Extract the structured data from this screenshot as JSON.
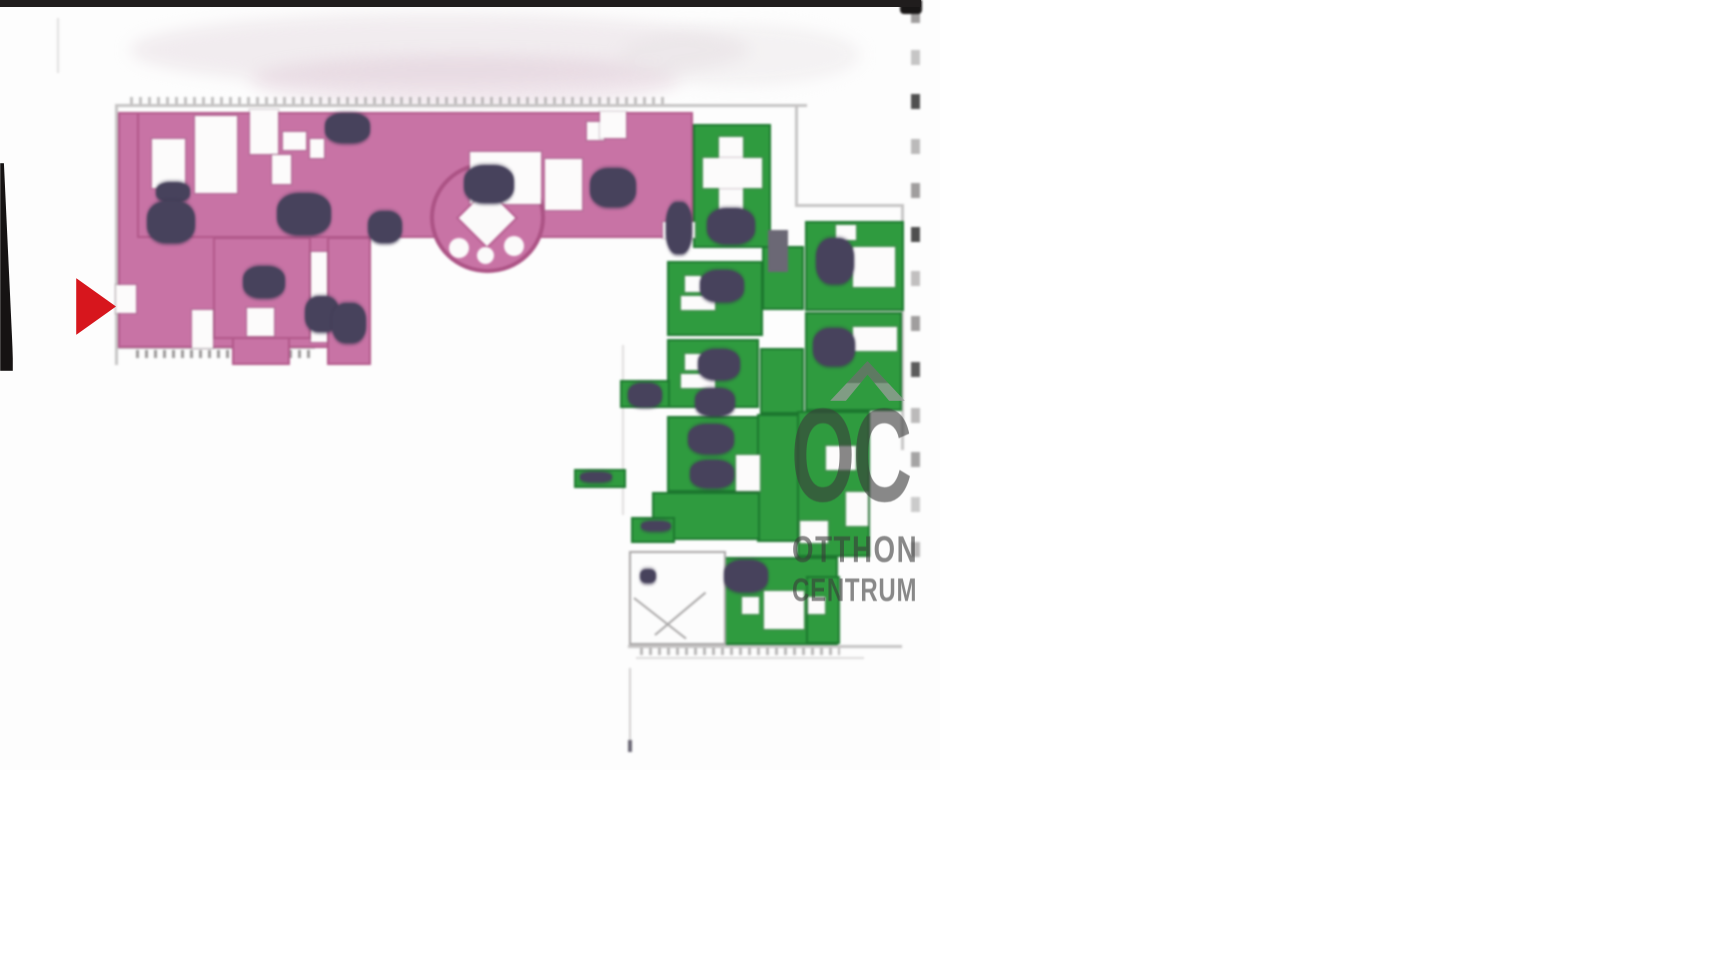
{
  "watermark": {
    "logo": "OC",
    "line1": "OTTHON",
    "line2": "CENTRUM",
    "color": "#6e6e6e"
  },
  "marker": {
    "color": "#d7161d"
  },
  "colors": {
    "highlight_pink": "#c873a5",
    "highlight_green": "#2f9b3f",
    "furniture_dark": "#47425c",
    "wall_gray": "#c6c4c4",
    "scan_bar_black": "#201d1d"
  },
  "floorplan": {
    "shapes": [
      {
        "c": "smudge",
        "x": 130,
        "y": 14,
        "w": 620,
        "h": 72,
        "bg": "rgba(226,216,222,0.45)"
      },
      {
        "c": "smudge",
        "x": 250,
        "y": 55,
        "w": 430,
        "h": 50,
        "bg": "rgba(219,196,209,0.4)"
      },
      {
        "c": "smudge",
        "x": 620,
        "y": 25,
        "w": 240,
        "h": 60,
        "bg": "rgba(230,224,228,0.4)"
      },
      {
        "c": "wall",
        "x": 115,
        "y": 104,
        "w": 692,
        "h": 3
      },
      {
        "c": "wall",
        "x": 115,
        "y": 107,
        "w": 3,
        "h": 258
      },
      {
        "c": "wall",
        "x": 795,
        "y": 107,
        "w": 3,
        "h": 100
      },
      {
        "c": "wall",
        "x": 795,
        "y": 204,
        "w": 109,
        "h": 3
      },
      {
        "c": "wall",
        "x": 901,
        "y": 204,
        "w": 3,
        "h": 246
      },
      {
        "c": "wall",
        "x": 115,
        "y": 346,
        "w": 200,
        "h": 3
      },
      {
        "c": "wall",
        "x": 628,
        "y": 645,
        "w": 274,
        "h": 3
      },
      {
        "c": "wall",
        "x": 636,
        "y": 657,
        "w": 228,
        "h": 2,
        "o": 0.6
      },
      {
        "c": "wall",
        "x": 622,
        "y": 345,
        "w": 2,
        "h": 170,
        "o": 0.55
      },
      {
        "c": "wall",
        "x": 57,
        "y": 18,
        "w": 2,
        "h": 55,
        "o": 0.5
      },
      {
        "c": "wall",
        "x": 629,
        "y": 668,
        "w": 2,
        "h": 78,
        "o": 0.8
      },
      {
        "c": "wall-dark",
        "x": 628,
        "y": 740,
        "w": 4,
        "h": 12
      },
      {
        "c": "ticks",
        "x": 136,
        "y": 350,
        "w": 175,
        "h": 8
      },
      {
        "c": "ticks",
        "x": 640,
        "y": 648,
        "w": 200,
        "h": 7,
        "o": 0.7
      },
      {
        "c": "ticks",
        "x": 130,
        "y": 97,
        "w": 540,
        "h": 7,
        "o": 0.6
      },
      {
        "c": "pink",
        "x": 118,
        "y": 112,
        "w": 227,
        "h": 236
      },
      {
        "c": "pink",
        "x": 137,
        "y": 112,
        "w": 556,
        "h": 126
      },
      {
        "c": "pink",
        "x": 213,
        "y": 237,
        "w": 98,
        "h": 102
      },
      {
        "c": "pink",
        "x": 232,
        "y": 337,
        "w": 58,
        "h": 28
      },
      {
        "c": "pink",
        "x": 327,
        "y": 237,
        "w": 44,
        "h": 128
      },
      {
        "c": "oval",
        "x": 430,
        "y": 162,
        "w": 115,
        "h": 111
      },
      {
        "c": "green",
        "x": 693,
        "y": 124,
        "w": 78,
        "h": 124
      },
      {
        "c": "green",
        "x": 805,
        "y": 221,
        "w": 99,
        "h": 90
      },
      {
        "c": "green",
        "x": 805,
        "y": 312,
        "w": 97,
        "h": 99
      },
      {
        "c": "green",
        "x": 667,
        "y": 261,
        "w": 96,
        "h": 75
      },
      {
        "c": "green",
        "x": 667,
        "y": 339,
        "w": 92,
        "h": 69
      },
      {
        "c": "green",
        "x": 620,
        "y": 380,
        "w": 50,
        "h": 28
      },
      {
        "c": "green",
        "x": 667,
        "y": 416,
        "w": 92,
        "h": 76
      },
      {
        "c": "green",
        "x": 762,
        "y": 246,
        "w": 42,
        "h": 64
      },
      {
        "c": "green",
        "x": 760,
        "y": 348,
        "w": 44,
        "h": 66
      },
      {
        "c": "green",
        "x": 757,
        "y": 414,
        "w": 45,
        "h": 128
      },
      {
        "c": "green",
        "x": 652,
        "y": 492,
        "w": 108,
        "h": 48
      },
      {
        "c": "green",
        "x": 631,
        "y": 517,
        "w": 44,
        "h": 26
      },
      {
        "c": "green",
        "x": 574,
        "y": 469,
        "w": 52,
        "h": 19
      },
      {
        "c": "green",
        "x": 722,
        "y": 557,
        "w": 116,
        "h": 88
      },
      {
        "c": "green",
        "x": 797,
        "y": 411,
        "w": 73,
        "h": 146
      },
      {
        "c": "green",
        "x": 806,
        "y": 576,
        "w": 34,
        "h": 68
      },
      {
        "c": "cutout",
        "x": 152,
        "y": 139,
        "w": 33,
        "h": 49
      },
      {
        "c": "cutout",
        "x": 195,
        "y": 116,
        "w": 42,
        "h": 77
      },
      {
        "c": "cutout",
        "x": 250,
        "y": 110,
        "w": 28,
        "h": 44
      },
      {
        "c": "cutout",
        "x": 272,
        "y": 155,
        "w": 19,
        "h": 29
      },
      {
        "c": "cutout",
        "x": 283,
        "y": 132,
        "w": 23,
        "h": 18
      },
      {
        "c": "cutout",
        "x": 310,
        "y": 139,
        "w": 14,
        "h": 19
      },
      {
        "c": "cutout",
        "x": 470,
        "y": 152,
        "w": 71,
        "h": 52
      },
      {
        "c": "cutout",
        "x": 545,
        "y": 159,
        "w": 37,
        "h": 51
      },
      {
        "c": "cutout",
        "x": 587,
        "y": 122,
        "w": 17,
        "h": 18
      },
      {
        "c": "cutout",
        "x": 600,
        "y": 112,
        "w": 26,
        "h": 26
      },
      {
        "c": "cutout",
        "x": 663,
        "y": 222,
        "w": 32,
        "h": 16
      },
      {
        "c": "cutout",
        "x": 192,
        "y": 310,
        "w": 21,
        "h": 38
      },
      {
        "c": "cutout",
        "x": 247,
        "y": 308,
        "w": 27,
        "h": 28
      },
      {
        "c": "cutout",
        "x": 311,
        "y": 252,
        "w": 16,
        "h": 90
      },
      {
        "c": "cutout",
        "x": 116,
        "y": 285,
        "w": 20,
        "h": 28
      },
      {
        "c": "diamond",
        "x": 467,
        "y": 198,
        "w": 40,
        "h": 40
      },
      {
        "c": "circle",
        "x": 449,
        "y": 238,
        "w": 20,
        "h": 20
      },
      {
        "c": "circle",
        "x": 477,
        "y": 247,
        "w": 17,
        "h": 17
      },
      {
        "c": "circle",
        "x": 504,
        "y": 236,
        "w": 20,
        "h": 20
      },
      {
        "c": "cutout",
        "x": 719,
        "y": 137,
        "w": 24,
        "h": 74
      },
      {
        "c": "cutout",
        "x": 703,
        "y": 158,
        "w": 59,
        "h": 30
      },
      {
        "c": "cutout",
        "x": 853,
        "y": 247,
        "w": 42,
        "h": 40
      },
      {
        "c": "cutout",
        "x": 836,
        "y": 225,
        "w": 20,
        "h": 15
      },
      {
        "c": "cutout",
        "x": 853,
        "y": 327,
        "w": 44,
        "h": 24
      },
      {
        "c": "cutout",
        "x": 685,
        "y": 276,
        "w": 16,
        "h": 16
      },
      {
        "c": "cutout",
        "x": 681,
        "y": 296,
        "w": 34,
        "h": 14
      },
      {
        "c": "cutout",
        "x": 685,
        "y": 354,
        "w": 16,
        "h": 16
      },
      {
        "c": "cutout",
        "x": 681,
        "y": 374,
        "w": 34,
        "h": 14
      },
      {
        "c": "cutout",
        "x": 736,
        "y": 455,
        "w": 24,
        "h": 36
      },
      {
        "c": "cutout",
        "x": 764,
        "y": 591,
        "w": 40,
        "h": 38
      },
      {
        "c": "cutout",
        "x": 742,
        "y": 597,
        "w": 17,
        "h": 17
      },
      {
        "c": "cutout",
        "x": 808,
        "y": 597,
        "w": 17,
        "h": 17
      },
      {
        "c": "cutout",
        "x": 826,
        "y": 446,
        "w": 30,
        "h": 24
      },
      {
        "c": "cutout",
        "x": 846,
        "y": 492,
        "w": 22,
        "h": 34
      },
      {
        "c": "cutout",
        "x": 800,
        "y": 521,
        "w": 28,
        "h": 22
      },
      {
        "c": "stair-room",
        "x": 629,
        "y": 551,
        "w": 97,
        "h": 94
      },
      {
        "c": "stair-line",
        "x": 634,
        "y": 597,
        "w": 66,
        "h": 2,
        "rot": 38
      },
      {
        "c": "stair-line",
        "x": 655,
        "y": 634,
        "w": 66,
        "h": 2,
        "rot": -40
      },
      {
        "c": "furn",
        "x": 640,
        "y": 569,
        "w": 16,
        "h": 14
      },
      {
        "c": "furn",
        "x": 156,
        "y": 182,
        "w": 34,
        "h": 20
      },
      {
        "c": "furn",
        "x": 147,
        "y": 201,
        "w": 48,
        "h": 42
      },
      {
        "c": "furn",
        "x": 277,
        "y": 193,
        "w": 54,
        "h": 42
      },
      {
        "c": "furn",
        "x": 325,
        "y": 113,
        "w": 45,
        "h": 30
      },
      {
        "c": "furn",
        "x": 368,
        "y": 211,
        "w": 34,
        "h": 32
      },
      {
        "c": "furn",
        "x": 464,
        "y": 165,
        "w": 50,
        "h": 38
      },
      {
        "c": "furn",
        "x": 590,
        "y": 168,
        "w": 46,
        "h": 39
      },
      {
        "c": "furn",
        "x": 666,
        "y": 202,
        "w": 26,
        "h": 52
      },
      {
        "c": "furn",
        "x": 243,
        "y": 266,
        "w": 42,
        "h": 32
      },
      {
        "c": "furn",
        "x": 305,
        "y": 296,
        "w": 34,
        "h": 36
      },
      {
        "c": "furn",
        "x": 332,
        "y": 303,
        "w": 34,
        "h": 40
      },
      {
        "c": "wall-dark",
        "x": 768,
        "y": 230,
        "w": 20,
        "h": 42
      },
      {
        "c": "furn",
        "x": 707,
        "y": 208,
        "w": 48,
        "h": 36
      },
      {
        "c": "furn",
        "x": 816,
        "y": 238,
        "w": 38,
        "h": 46
      },
      {
        "c": "furn",
        "x": 813,
        "y": 328,
        "w": 42,
        "h": 38
      },
      {
        "c": "furn",
        "x": 700,
        "y": 270,
        "w": 44,
        "h": 32
      },
      {
        "c": "furn",
        "x": 698,
        "y": 349,
        "w": 42,
        "h": 31
      },
      {
        "c": "furn",
        "x": 688,
        "y": 424,
        "w": 46,
        "h": 30
      },
      {
        "c": "furn",
        "x": 628,
        "y": 383,
        "w": 34,
        "h": 24
      },
      {
        "c": "furn",
        "x": 695,
        "y": 388,
        "w": 40,
        "h": 28
      },
      {
        "c": "furn",
        "x": 690,
        "y": 460,
        "w": 44,
        "h": 28
      },
      {
        "c": "furn",
        "x": 641,
        "y": 521,
        "w": 30,
        "h": 10
      },
      {
        "c": "furn",
        "x": 580,
        "y": 472,
        "w": 32,
        "h": 10
      },
      {
        "c": "furn",
        "x": 724,
        "y": 560,
        "w": 44,
        "h": 32
      },
      {
        "c": "dash",
        "x": 911,
        "y": 8,
        "w": 9,
        "h": 15,
        "o": 0.85
      },
      {
        "c": "dash",
        "x": 911,
        "y": 50,
        "w": 9,
        "h": 15,
        "o": 0.5
      },
      {
        "c": "dash",
        "x": 911,
        "y": 94,
        "w": 9,
        "h": 15,
        "bg": "#4f4f4f"
      },
      {
        "c": "dash",
        "x": 911,
        "y": 139,
        "w": 9,
        "h": 15,
        "o": 0.6
      },
      {
        "c": "dash",
        "x": 911,
        "y": 183,
        "w": 9,
        "h": 15,
        "o": 0.85
      },
      {
        "c": "dash",
        "x": 911,
        "y": 227,
        "w": 9,
        "h": 15,
        "bg": "#4f4f4f"
      },
      {
        "c": "dash",
        "x": 911,
        "y": 271,
        "w": 9,
        "h": 15,
        "o": 0.55
      },
      {
        "c": "dash",
        "x": 911,
        "y": 316,
        "w": 9,
        "h": 15,
        "o": 0.85
      },
      {
        "c": "dash",
        "x": 911,
        "y": 362,
        "w": 9,
        "h": 15,
        "bg": "#5c5c5c"
      },
      {
        "c": "dash",
        "x": 911,
        "y": 408,
        "w": 9,
        "h": 15,
        "o": 0.6
      },
      {
        "c": "dash",
        "x": 911,
        "y": 452,
        "w": 9,
        "h": 15,
        "o": 0.8
      },
      {
        "c": "dash",
        "x": 911,
        "y": 497,
        "w": 9,
        "h": 15,
        "o": 0.45
      },
      {
        "c": "dash",
        "x": 911,
        "y": 542,
        "w": 9,
        "h": 15,
        "o": 0.6
      },
      {
        "c": "blob",
        "x": 900,
        "y": 0,
        "w": 22,
        "h": 14
      }
    ]
  }
}
